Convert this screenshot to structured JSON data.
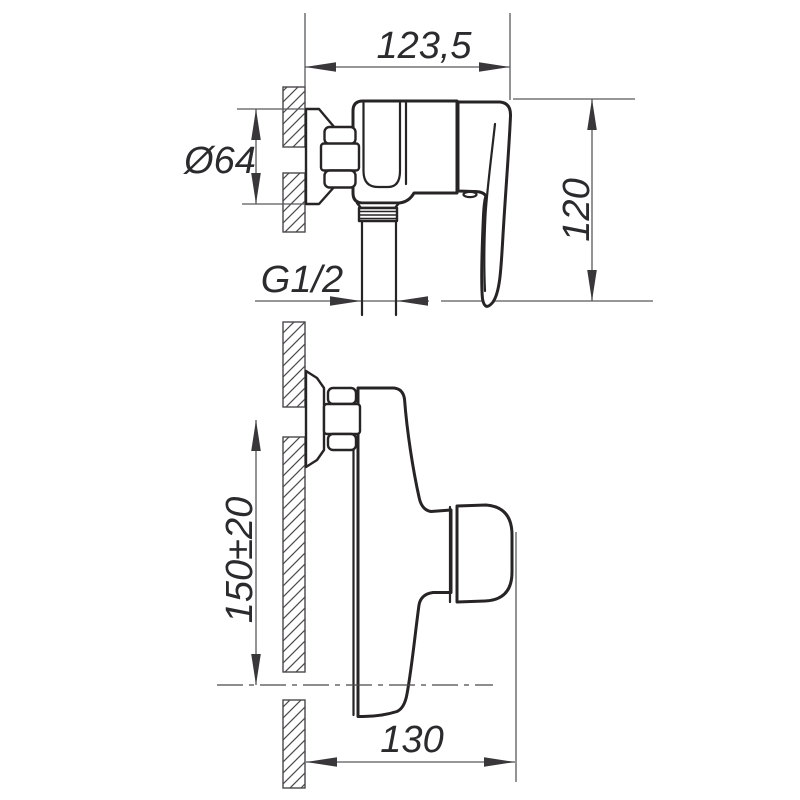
{
  "drawing": {
    "type": "technical-dimension-drawing",
    "subject": "wall-mounted shower mixer faucet, side view (top) and front view (bottom)",
    "ink_color": "#272425",
    "dim_line_color": "#58595b",
    "background": "#ffffff",
    "dimensions": {
      "overall_depth": "123,5",
      "flange_diameter": "Ø64",
      "side_height": "120",
      "outlet_thread": "G1/2",
      "mount_distance": "150±20",
      "overall_width": "130"
    }
  }
}
